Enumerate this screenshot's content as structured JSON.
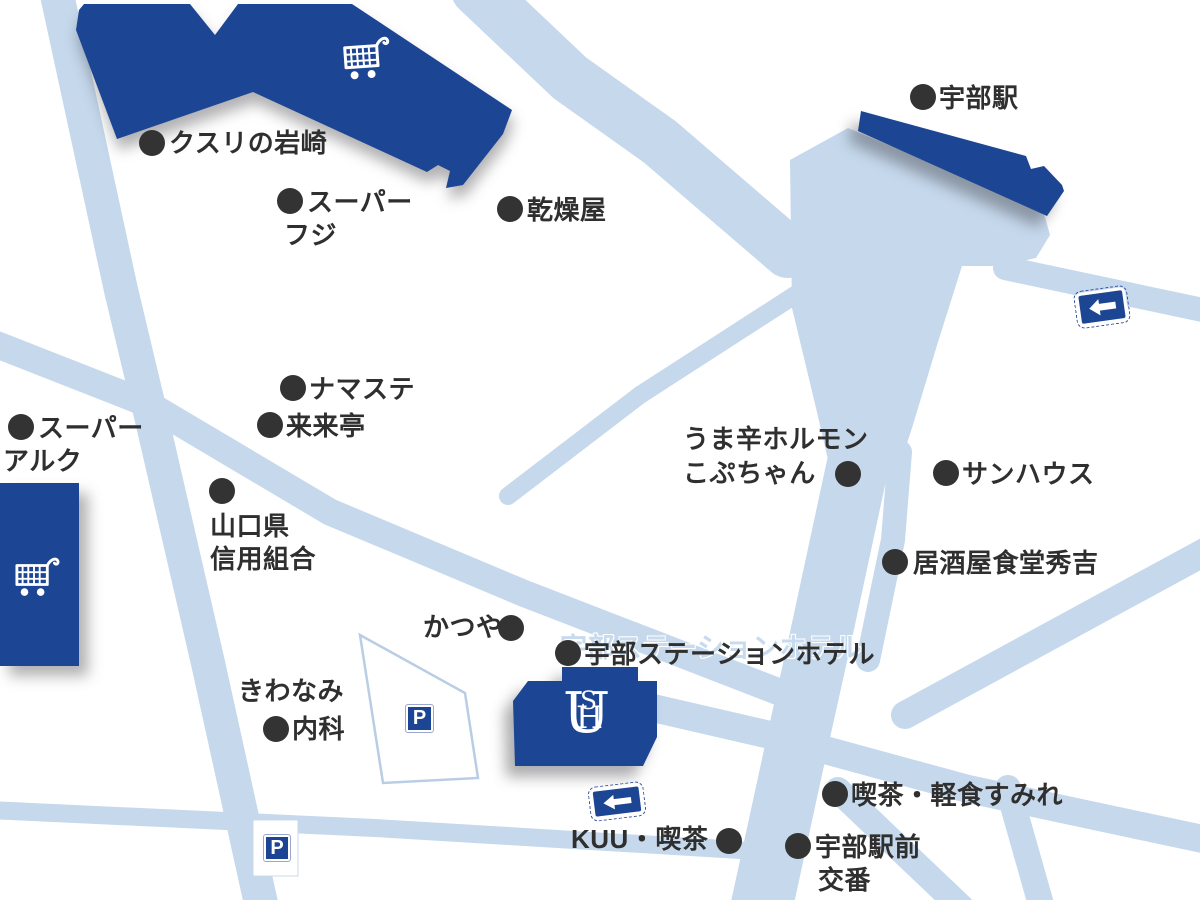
{
  "map_title": "宇部ステーションホテル周辺地図",
  "colors": {
    "building_blue": "#1c4594",
    "road_blue": "#c5d8ec",
    "label_dark": "#2f2f2f",
    "sign_blue": "#1c4594",
    "ghost_blue": "#c8daed"
  },
  "pois": [
    {
      "id": "kusuri-no-iwasaki",
      "dot": {
        "x": 152,
        "y": 143
      },
      "texts": [
        {
          "x": 169,
          "y": 129,
          "text": "クスリの岩崎"
        }
      ]
    },
    {
      "id": "super-fuji",
      "dot": {
        "x": 290,
        "y": 201
      },
      "texts": [
        {
          "x": 307,
          "y": 188,
          "text": "スーパー"
        },
        {
          "x": 284,
          "y": 221,
          "text": "フジ"
        }
      ]
    },
    {
      "id": "kansouya",
      "dot": {
        "x": 510,
        "y": 209
      },
      "texts": [
        {
          "x": 527,
          "y": 196,
          "text": "乾燥屋"
        }
      ]
    },
    {
      "id": "ube-station",
      "dot": {
        "x": 923,
        "y": 97
      },
      "texts": [
        {
          "x": 939,
          "y": 84,
          "text": "宇部駅"
        }
      ]
    },
    {
      "id": "namaste",
      "dot": {
        "x": 293,
        "y": 388
      },
      "texts": [
        {
          "x": 309,
          "y": 375,
          "text": "ナマステ"
        }
      ]
    },
    {
      "id": "rairaitei",
      "dot": {
        "x": 270,
        "y": 425
      },
      "texts": [
        {
          "x": 286,
          "y": 412,
          "text": "来来亭"
        }
      ]
    },
    {
      "id": "super-aruku",
      "dot": {
        "x": 21,
        "y": 427
      },
      "texts": [
        {
          "x": 38,
          "y": 414,
          "text": "スーパー"
        },
        {
          "x": 3,
          "y": 447,
          "text": "アルク"
        }
      ]
    },
    {
      "id": "yamaguchiken-shinyokumiai",
      "dot": {
        "x": 222,
        "y": 491
      },
      "texts": [
        {
          "x": 210,
          "y": 512,
          "text": "山口県"
        },
        {
          "x": 210,
          "y": 545,
          "text": "信用組合"
        }
      ]
    },
    {
      "id": "umakara-horumon-kopuchan",
      "dot": {
        "x": 848,
        "y": 474
      },
      "texts": [
        {
          "x": 683,
          "y": 425,
          "text": "うま辛ホルモン"
        },
        {
          "x": 683,
          "y": 459,
          "text": "こぷちゃん"
        }
      ]
    },
    {
      "id": "sunhouse",
      "dot": {
        "x": 946,
        "y": 473
      },
      "texts": [
        {
          "x": 962,
          "y": 460,
          "text": "サンハウス"
        }
      ]
    },
    {
      "id": "izakaya-shokudo-hideyoshi",
      "dot": {
        "x": 895,
        "y": 562
      },
      "texts": [
        {
          "x": 913,
          "y": 549,
          "text": "居酒屋食堂秀吉"
        }
      ]
    },
    {
      "id": "katsuya",
      "dot": {
        "x": 511,
        "y": 628
      },
      "texts": [
        {
          "x": 423,
          "y": 613,
          "text": "かつや"
        }
      ]
    },
    {
      "id": "ube-station-hotel",
      "dot": {
        "x": 568,
        "y": 653
      },
      "texts": [
        {
          "x": 584,
          "y": 640,
          "text": "宇部ステーションホテル"
        }
      ]
    },
    {
      "id": "kiwanami-naika",
      "dot": {
        "x": 276,
        "y": 729
      },
      "texts": [
        {
          "x": 238,
          "y": 677,
          "text": "きわなみ"
        },
        {
          "x": 292,
          "y": 715,
          "text": "内科"
        }
      ]
    },
    {
      "id": "kuu-kissa",
      "dot": {
        "x": 729,
        "y": 841
      },
      "texts": [
        {
          "x": 571,
          "y": 825,
          "text": "KUU・喫茶"
        }
      ]
    },
    {
      "id": "kissa-keishoku-sumire",
      "dot": {
        "x": 835,
        "y": 794
      },
      "texts": [
        {
          "x": 851,
          "y": 781,
          "text": "喫茶・軽食すみれ"
        }
      ]
    },
    {
      "id": "ube-ekimae-koban",
      "dot": {
        "x": 798,
        "y": 846
      },
      "texts": [
        {
          "x": 815,
          "y": 833,
          "text": "宇部駅前"
        },
        {
          "x": 818,
          "y": 866,
          "text": "交番"
        }
      ]
    }
  ],
  "ghost_label": {
    "text": "宇部ステーションホテル",
    "x": 560,
    "y": 626
  },
  "hotel_logo": {
    "letters": [
      "U",
      "S",
      "H"
    ]
  },
  "parking_signs": [
    {
      "id": "parking-sign-hotel",
      "label": "P",
      "x": 406,
      "y": 705,
      "size": 27
    },
    {
      "id": "parking-sign-south",
      "label": "P",
      "x": 264,
      "y": 835,
      "size": 26
    }
  ],
  "one_way_signs": [
    {
      "id": "one-way-sign-station",
      "x": 1075,
      "y": 288,
      "w": 54,
      "h": 38,
      "rot": -8
    },
    {
      "id": "one-way-sign-hotel",
      "x": 589,
      "y": 784,
      "w": 56,
      "h": 35,
      "rot": -7
    }
  ]
}
